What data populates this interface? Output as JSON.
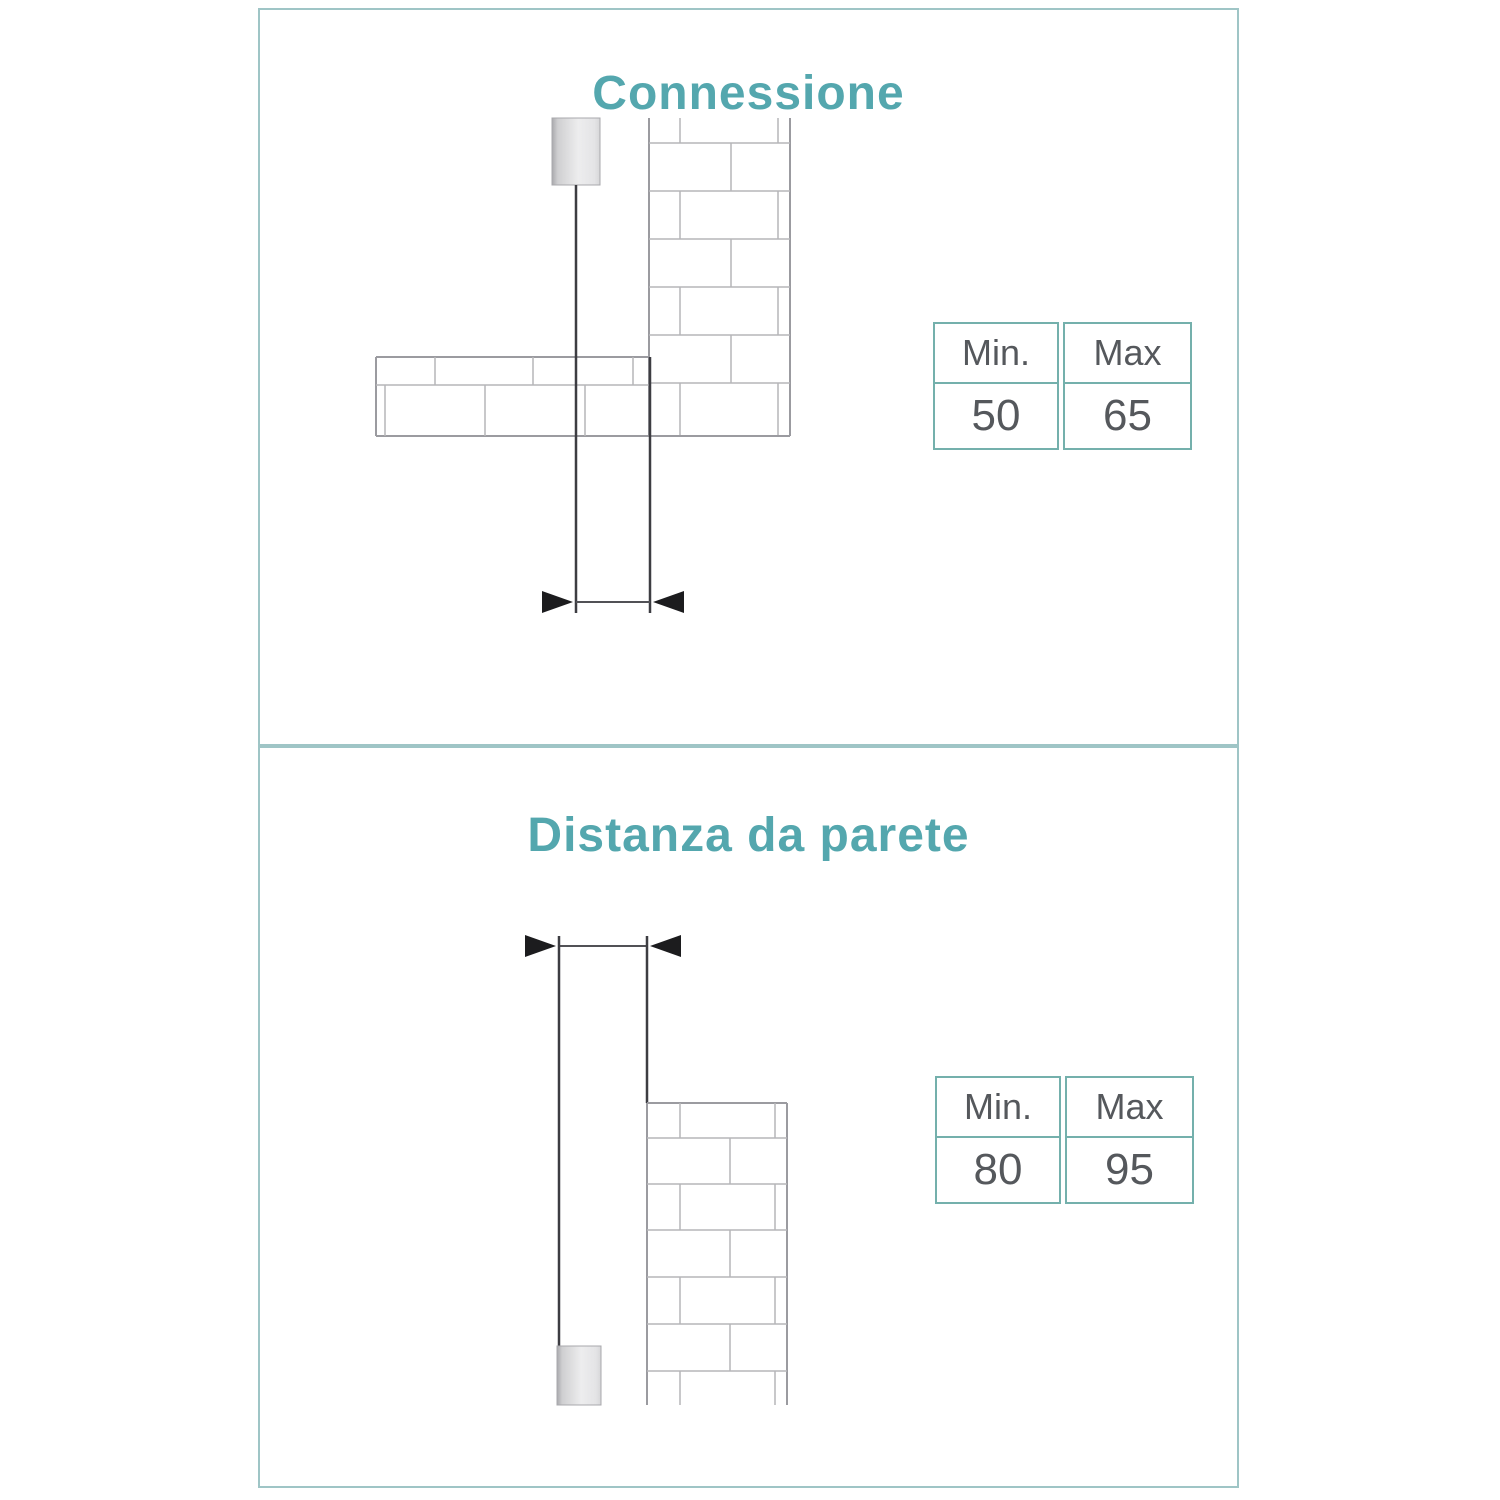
{
  "document": {
    "type": "product-installation-spec",
    "language": "it"
  },
  "colors": {
    "accent_teal_title": "#54a7ae",
    "panel_border_teal": "#9fc5c6",
    "table_border_teal": "#74b0ac",
    "table_text_gray": "#55585c",
    "drawing_dark_line": "#3d3d42",
    "brick_line_gray": "#b6b6b9",
    "arrow_black": "#1c1c1e"
  },
  "panels": [
    {
      "title": "Connessione",
      "diagram_description": "pendant canopy hanging beside ceiling beam and brick wall with dimension arrows",
      "table": {
        "min_label": "Min.",
        "max_label": "Max",
        "min_value": "50",
        "max_value": "65"
      }
    },
    {
      "title": "Distanza da parete",
      "diagram_description": "pendant cylinder hanging beside brick wall with dimension arrows at top",
      "table": {
        "min_label": "Min.",
        "max_label": "Max",
        "min_value": "80",
        "max_value": "95"
      }
    }
  ]
}
